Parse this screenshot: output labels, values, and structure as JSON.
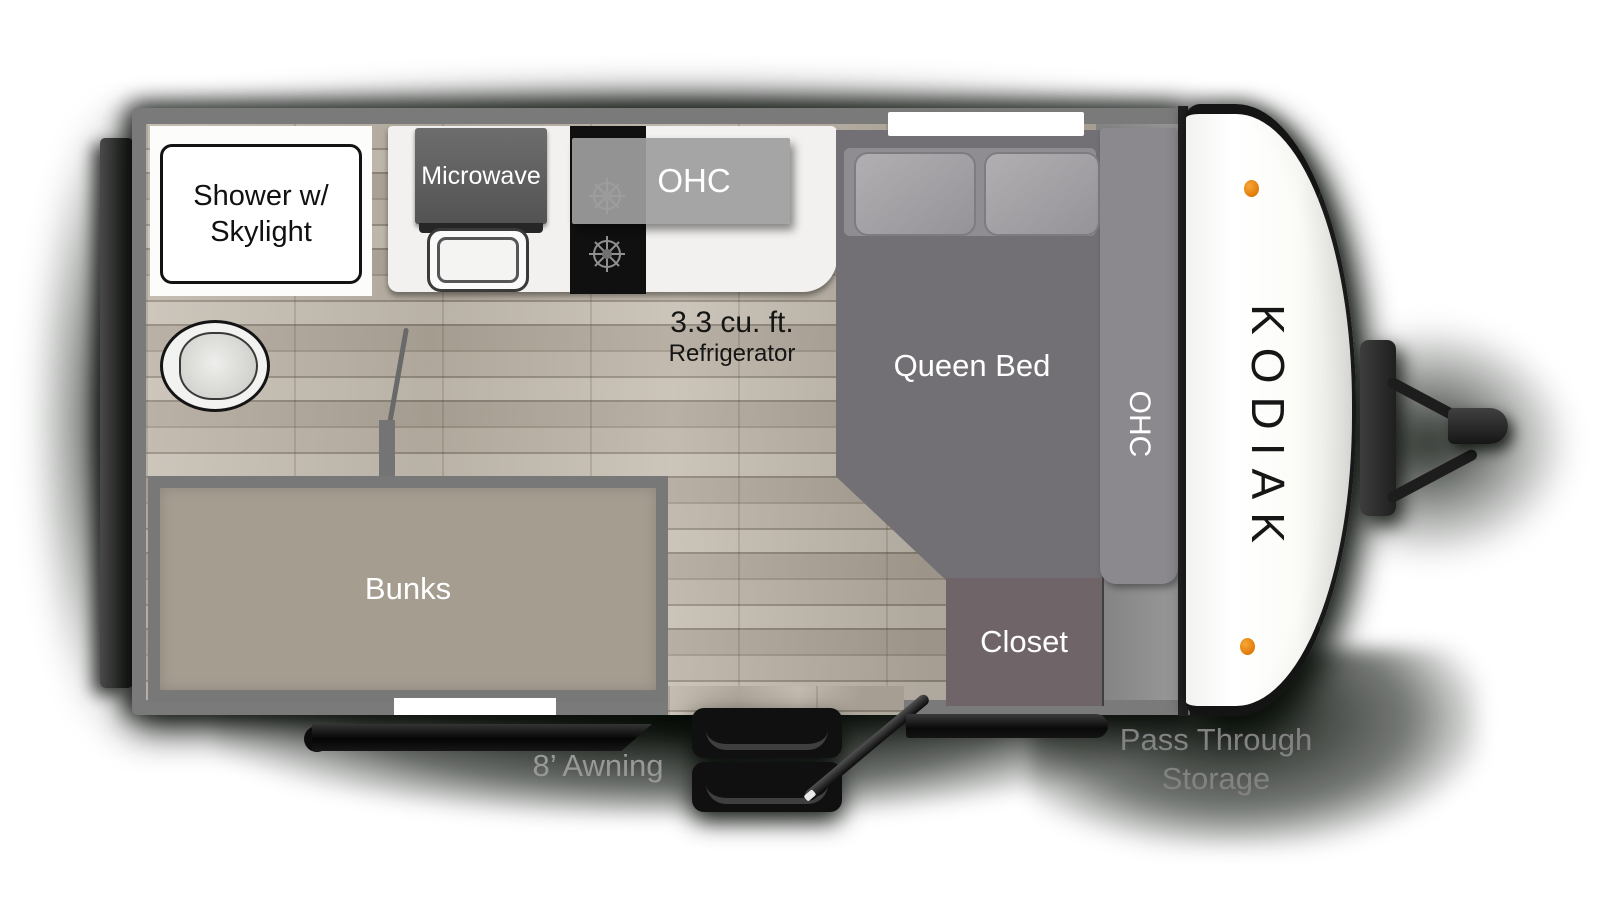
{
  "title": "Kodiak travel trailer floor plan",
  "brand": "KODIAK",
  "labels": {
    "shower_line1": "Shower w/",
    "shower_line2": "Skylight",
    "microwave": "Microwave",
    "kitchen_ohc": "OHC",
    "fridge_line1": "3.3 cu. ft.",
    "fridge_line2": "Refrigerator",
    "queen_bed": "Queen Bed",
    "bed_ohc": "OHC",
    "closet": "Closet",
    "bunks": "Bunks",
    "awning": "8’ Awning",
    "pass_through_line1": "Pass Through",
    "pass_through_line2": "Storage"
  },
  "colors": {
    "wall_gray": "#7a7a7a",
    "floor_wood": "#b4ab9e",
    "counter_white": "#f2f1ef",
    "appliance_gray": "#5f5f5f",
    "cooktop_black": "#101010",
    "overhead_cabinet_gray": "#9e9e9e",
    "bed_gray": "#727075",
    "closet_gray": "#6f6569",
    "bunks_taupe": "#a69d91",
    "front_cap_white": "#fafaf8",
    "marker_light_orange": "#e8860f",
    "frame_black": "#141414",
    "label_white": "#ffffff",
    "label_black": "#1a1a1a",
    "label_gray": "#8f8f8f"
  }
}
